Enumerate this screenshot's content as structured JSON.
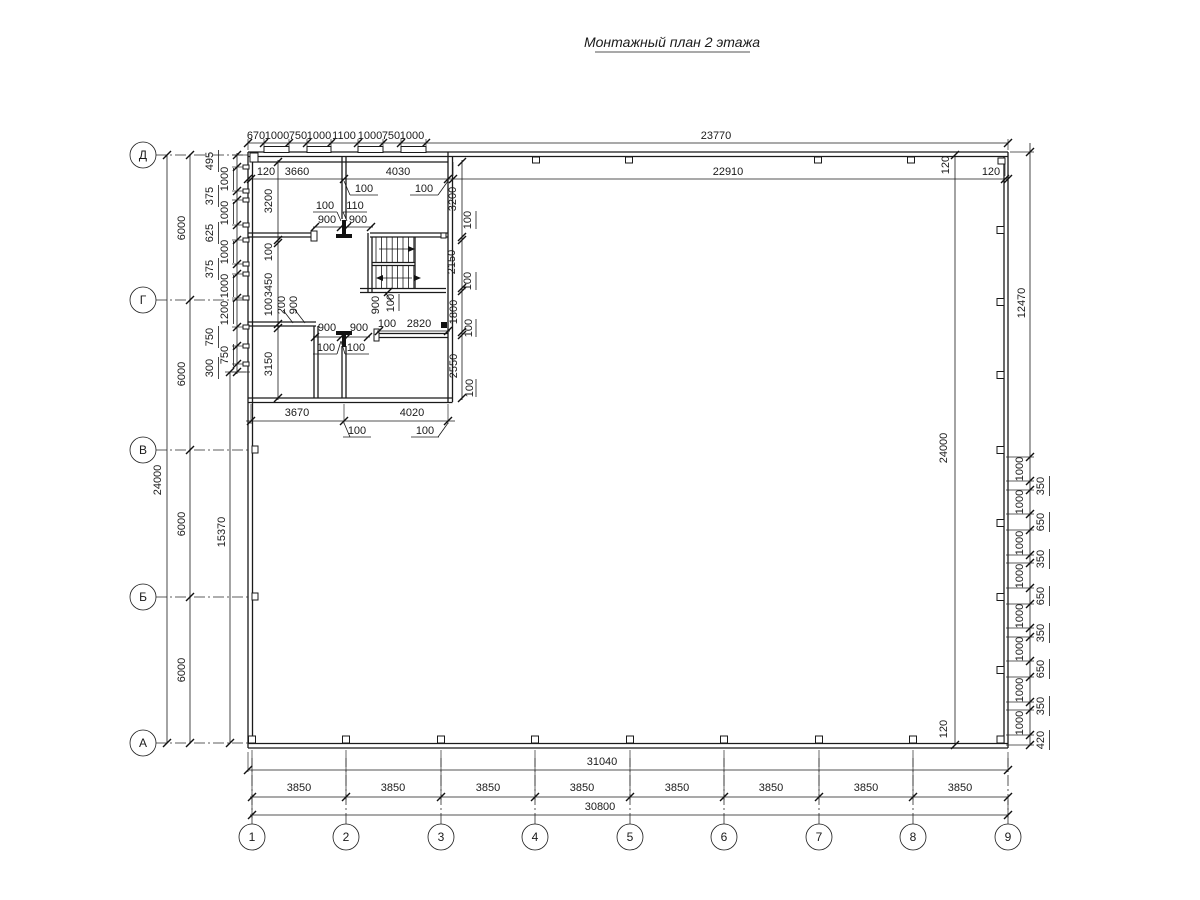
{
  "title": "Монтажный план 2 этажа",
  "axes": {
    "bottom": [
      "1",
      "2",
      "3",
      "4",
      "5",
      "6",
      "7",
      "8",
      "9"
    ],
    "left": [
      "Д",
      "Г",
      "В",
      "Б",
      "А"
    ]
  },
  "dims": {
    "top_chain": [
      "670",
      "1000",
      "750",
      "1000",
      "1100",
      "1000",
      "750",
      "1000"
    ],
    "top_overall": "23770",
    "top_inner": "22910",
    "wall_offset": "120",
    "room1_w": "3660",
    "room2_w": "4030",
    "d100": "100",
    "d110": "110",
    "d900": "900",
    "d200": "200",
    "left_room_top_h": "3200",
    "left_room_mid_h": "3450",
    "left_room_bot_h": "3150",
    "right_room_top_h": "3200",
    "stair_h": "2150",
    "hall_h": "1800",
    "right_room_bot_h": "2550",
    "hall_w": "2820",
    "bottom_room1_w": "3670",
    "bottom_room2_w": "4020",
    "left_chain": [
      "495",
      "1000",
      "375",
      "1000",
      "625",
      "1000",
      "375",
      "1000",
      "1200",
      "750",
      "750",
      "300"
    ],
    "axis_step_v": "6000",
    "total_v": "24000",
    "inner_v": "15370",
    "right_overall": "12470",
    "right_chain_1000": "1000",
    "right_chain_small": [
      "350",
      "650",
      "350",
      "650",
      "350",
      "650",
      "350",
      "420"
    ],
    "bay_w": "3850",
    "bottom_inner": "31040",
    "bottom_overall": "30800"
  }
}
